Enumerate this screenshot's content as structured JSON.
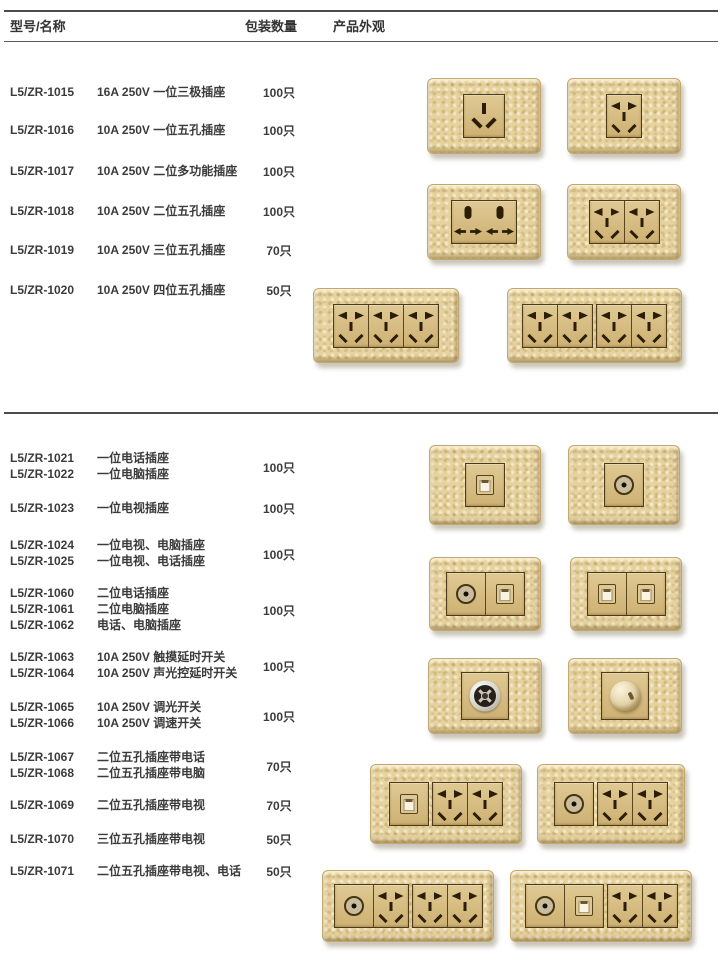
{
  "header": {
    "col_model_name": "型号/名称",
    "col_quantity": "包装数量",
    "col_appearance": "产品外观"
  },
  "catalog": {
    "top_groups": [
      {
        "models": [
          "L5/ZR-1015"
        ],
        "descs": [
          "16A 250V 一位三极插座"
        ],
        "qty": "100只"
      },
      {
        "models": [
          "L5/ZR-1016"
        ],
        "descs": [
          "10A 250V 一位五孔插座"
        ],
        "qty": "100只"
      },
      {
        "models": [
          "L5/ZR-1017"
        ],
        "descs": [
          "10A 250V 二位多功能插座"
        ],
        "qty": "100只"
      },
      {
        "models": [
          "L5/ZR-1018"
        ],
        "descs": [
          "10A 250V 二位五孔插座"
        ],
        "qty": "100只"
      },
      {
        "models": [
          "L5/ZR-1019"
        ],
        "descs": [
          "10A 250V 三位五孔插座"
        ],
        "qty": "70只"
      },
      {
        "models": [
          "L5/ZR-1020"
        ],
        "descs": [
          "10A 250V 四位五孔插座"
        ],
        "qty": "50只"
      }
    ],
    "bottom_groups": [
      {
        "models": [
          "L5/ZR-1021",
          "L5/ZR-1022"
        ],
        "descs": [
          "一位电话插座",
          "一位电脑插座"
        ],
        "qty": "100只"
      },
      {
        "models": [
          "L5/ZR-1023"
        ],
        "descs": [
          "一位电视插座"
        ],
        "qty": "100只"
      },
      {
        "models": [
          "L5/ZR-1024",
          "L5/ZR-1025"
        ],
        "descs": [
          "一位电视、电脑插座",
          "一位电视、电话插座"
        ],
        "qty": "100只"
      },
      {
        "models": [
          "L5/ZR-1060",
          "L5/ZR-1061",
          "L5/ZR-1062"
        ],
        "descs": [
          "二位电话插座",
          "二位电脑插座",
          "电话、电脑插座"
        ],
        "qty": "100只"
      },
      {
        "models": [
          "L5/ZR-1063",
          "L5/ZR-1064"
        ],
        "descs": [
          "10A 250V 触摸延时开关",
          "10A 250V 声光控延时开关"
        ],
        "qty": "100只"
      },
      {
        "models": [
          "L5/ZR-1065",
          "L5/ZR-1066"
        ],
        "descs": [
          "10A 250V 调光开关",
          "10A 250V 调速开关"
        ],
        "qty": "100只"
      },
      {
        "models": [
          "L5/ZR-1067",
          "L5/ZR-1068"
        ],
        "descs": [
          "二位五孔插座带电话",
          "二位五孔插座带电脑"
        ],
        "qty": "70只"
      },
      {
        "models": [
          "L5/ZR-1069"
        ],
        "descs": [
          "二位五孔插座带电视"
        ],
        "qty": "70只"
      },
      {
        "models": [
          "L5/ZR-1070"
        ],
        "descs": [
          "三位五孔插座带电视"
        ],
        "qty": "50只"
      },
      {
        "models": [
          "L5/ZR-1071"
        ],
        "descs": [
          "二位五孔插座带电视、电话"
        ],
        "qty": "50只"
      }
    ]
  },
  "products": [
    {
      "id": "1015",
      "frames": [
        [
          "three"
        ]
      ]
    },
    {
      "id": "1016",
      "frames": [
        [
          "five"
        ]
      ]
    },
    {
      "id": "1017",
      "frames": [
        [
          "multi",
          "multi"
        ]
      ]
    },
    {
      "id": "1018",
      "frames": [
        [
          "five",
          "five"
        ]
      ]
    },
    {
      "id": "1019",
      "frames": [
        [
          "five",
          "five",
          "five"
        ]
      ]
    },
    {
      "id": "1020",
      "frames": [
        [
          "five",
          "five"
        ],
        [
          "five",
          "five"
        ]
      ]
    },
    {
      "id": "1021",
      "frames": [
        [
          "rj"
        ]
      ]
    },
    {
      "id": "1023",
      "frames": [
        [
          "tv"
        ]
      ]
    },
    {
      "id": "1024",
      "frames": [
        [
          "tv",
          "rj"
        ]
      ]
    },
    {
      "id": "1060",
      "frames": [
        [
          "rj",
          "rj"
        ]
      ]
    },
    {
      "id": "1063",
      "frames": [
        [
          "touch"
        ]
      ]
    },
    {
      "id": "1065",
      "frames": [
        [
          "dimmer"
        ]
      ]
    },
    {
      "id": "1067",
      "frames": [
        [
          "rj"
        ],
        [
          "five",
          "five"
        ]
      ]
    },
    {
      "id": "1069",
      "frames": [
        [
          "tv"
        ],
        [
          "five",
          "five"
        ]
      ]
    },
    {
      "id": "1070",
      "frames": [
        [
          "tv",
          "five"
        ],
        [
          "five",
          "five"
        ]
      ]
    },
    {
      "id": "1071",
      "frames": [
        [
          "tv",
          "rj"
        ],
        [
          "five",
          "five"
        ]
      ]
    }
  ],
  "icons": {
    "three": "three-pin-socket-icon",
    "five": "five-hole-socket-icon",
    "multi": "multi-function-socket-icon",
    "rj": "phone-computer-jack-icon",
    "tv": "tv-coax-socket-icon",
    "touch": "touch-delay-switch-icon",
    "dimmer": "dimmer-knob-icon"
  },
  "colors": {
    "plate_gold": "#e6d29e",
    "module_gold": "#d6bc82",
    "slot_brown": "#2b1d06",
    "text_gray": "#3b3b3b",
    "rule_gray": "#4c4c4c",
    "page_bg": "#ffffff"
  }
}
